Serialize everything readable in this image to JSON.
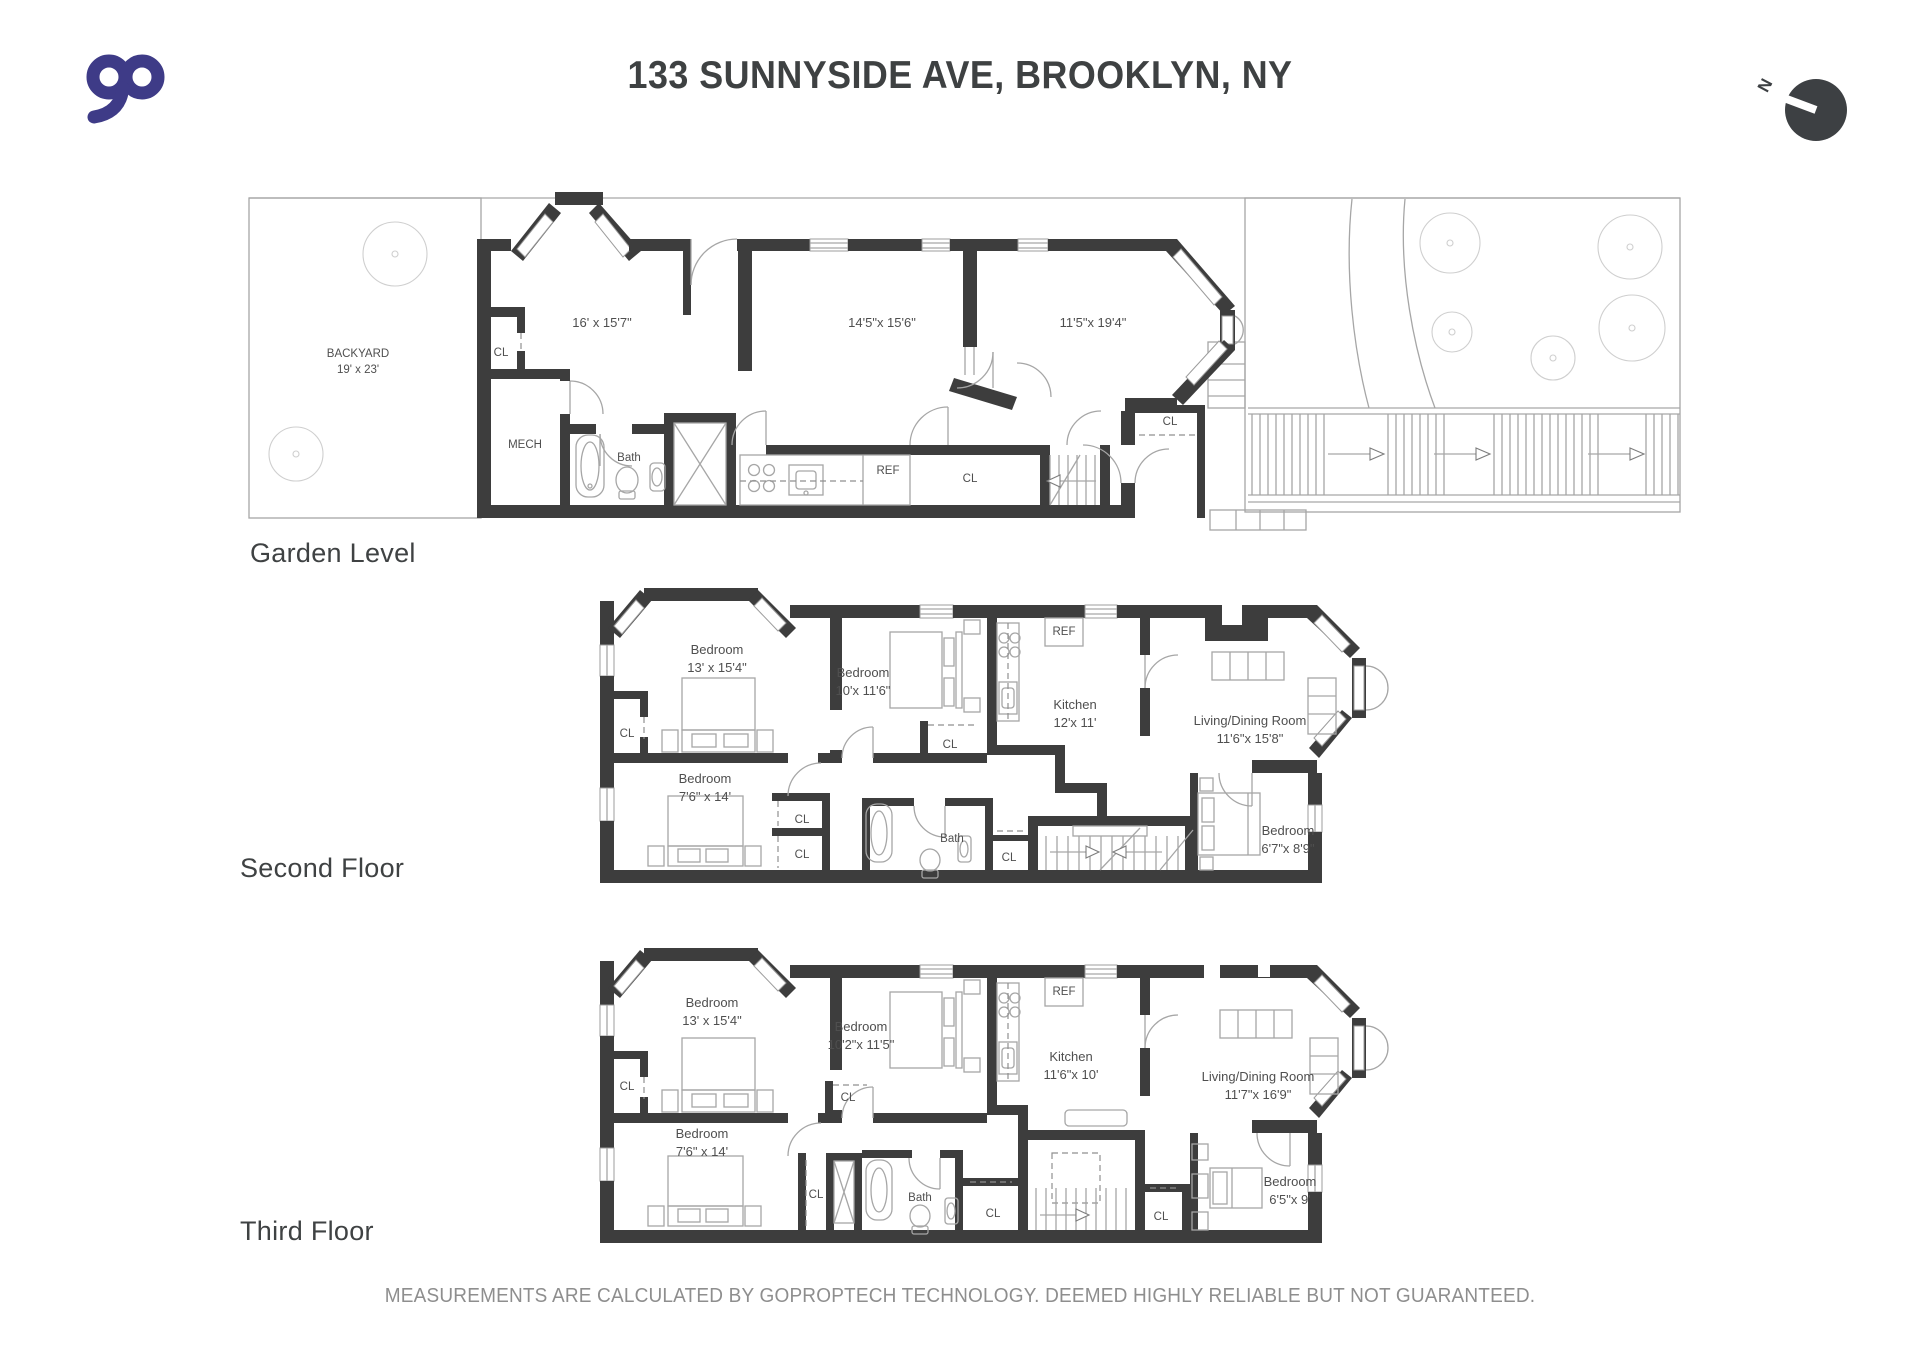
{
  "header": {
    "logo_text": "go",
    "title": "133 SUNNYSIDE AVE, BROOKLYN, NY",
    "compass_n": "N"
  },
  "floors": [
    {
      "name": "Garden Level",
      "labels": {
        "backyard_name": "BACKYARD",
        "backyard_dims": "19' x 23'",
        "cl_front": "CL",
        "room1_dims": "16' x 15'7\"",
        "room2_dims": "14'5\"x 15'6\"",
        "room3_dims": "11'5\"x 19'4\"",
        "mech": "MECH",
        "bath": "Bath",
        "ref": "REF",
        "cl_hall": "CL",
        "cl_entry": "CL"
      }
    },
    {
      "name": "Second Floor",
      "labels": {
        "bedroom1_name": "Bedroom",
        "bedroom1_dims": "13' x 15'4\"",
        "bedroom2_name": "Bedroom",
        "bedroom2_dims": "10'x 11'6\"",
        "bedroom3_name": "Bedroom",
        "bedroom3_dims": "7'6\" x 14'",
        "bedroom4_name": "Bedroom",
        "bedroom4_dims": "6'7\"x 8'9\"",
        "kitchen_name": "Kitchen",
        "kitchen_dims": "12'x 11'",
        "living_name": "Living/Dining Room",
        "living_dims": "11'6\"x 15'8\"",
        "bath": "Bath",
        "ref": "REF",
        "cl_left": "CL",
        "cl_upper": "CL",
        "cl_lower": "CL",
        "cl_bed2": "CL",
        "cl_hall": "CL"
      }
    },
    {
      "name": "Third Floor",
      "labels": {
        "bedroom1_name": "Bedroom",
        "bedroom1_dims": "13' x 15'4\"",
        "bedroom2_name": "Bedroom",
        "bedroom2_dims": "10'2\"x 11'5\"",
        "bedroom3_name": "Bedroom",
        "bedroom3_dims": "7'6\" x 14'",
        "bedroom4_name": "Bedroom",
        "bedroom4_dims": "6'5\"x 9'",
        "kitchen_name": "Kitchen",
        "kitchen_dims": "11'6\"x 10'",
        "living_name": "Living/Dining Room",
        "living_dims": "11'7\"x 16'9\"",
        "bath": "Bath",
        "ref": "REF",
        "cl_left": "CL",
        "cl_mid": "CL",
        "cl_bed2": "CL",
        "cl_bath": "CL",
        "cl_stairs": "CL"
      }
    }
  ],
  "footer": {
    "disclaimer": "MEASUREMENTS ARE CALCULATED BY GOPROPTECH TECHNOLOGY. DEEMED HIGHLY RELIABLE BUT NOT GUARANTEED."
  },
  "colors": {
    "logo": "#3e3b87",
    "wall": "#3d3d3d",
    "line": "#a6a6a6",
    "text": "#4f4f4f"
  }
}
